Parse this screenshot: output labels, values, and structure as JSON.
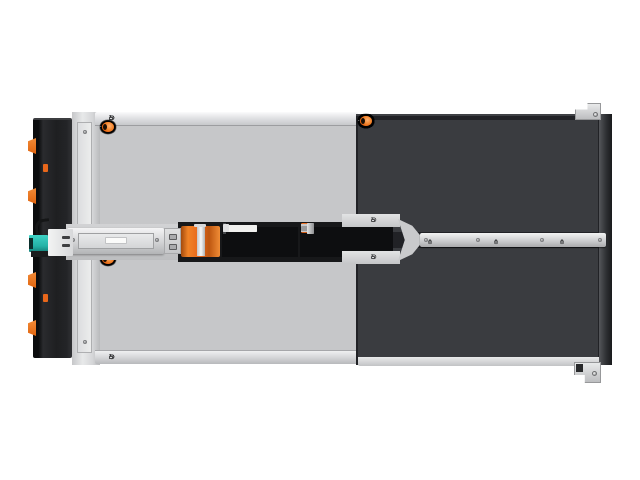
{
  "image": {
    "subject": "Top view product photo of a high-density rackmount JBOD storage enclosure fully populated with hot-swap drive carriers",
    "background": "#ffffff"
  },
  "palette": {
    "accent_orange": "#e8671b",
    "chassis_silver": "#d8d9db",
    "carrier_frame_left_half": "#3f4145",
    "carrier_frame_right_half": "#26282b",
    "rear_panel_black": "#1e1f21",
    "cable_connector_teal": "#2cc3b7"
  },
  "enclosure": {
    "marking": {
      "i": "i",
      "o": "⊙"
    },
    "left_section": {
      "columns": 4,
      "rows_top": 6,
      "rows_bottom": 6,
      "marking_count": 4
    },
    "right_section": {
      "columns": 4,
      "rows_top": 7,
      "rows_bottom": 7,
      "mini_marking_groups": 3
    }
  }
}
